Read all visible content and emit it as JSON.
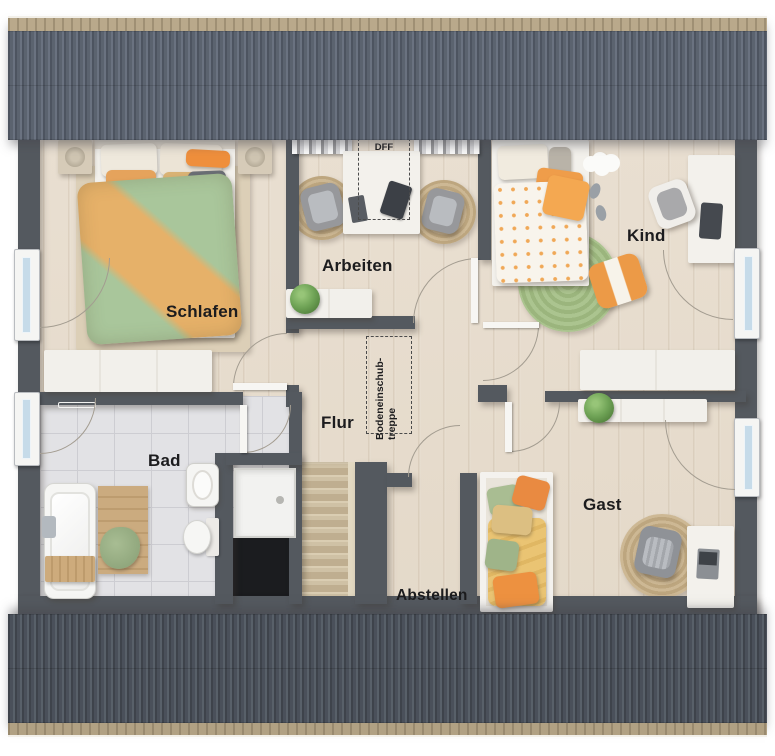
{
  "floorplan": {
    "rooms": [
      {
        "id": "schlafen",
        "label": "Schlafen"
      },
      {
        "id": "arbeiten",
        "label": "Arbeiten"
      },
      {
        "id": "kind",
        "label": "Kind"
      },
      {
        "id": "flur",
        "label": "Flur"
      },
      {
        "id": "bad",
        "label": "Bad"
      },
      {
        "id": "gast",
        "label": "Gast"
      },
      {
        "id": "abstellen",
        "label": "Abstellen"
      }
    ],
    "annotations": {
      "roof_window": "DFF",
      "attic_hatch_line1": "Bodeneinschub-",
      "attic_hatch_line2": "treppe"
    },
    "colors": {
      "roof_top": "#5b636f",
      "roof_bottom": "#4a505a",
      "roof_ridge": "#b9a98b",
      "wall": "#54595f",
      "wood_floor": "#e6dccd",
      "bath_tile": "#e2e2e5",
      "stair_wood": "#cfc1a5",
      "accent_orange": "#ec9a47",
      "accent_green": "#a9c69b",
      "rug_jute": "#cdb894",
      "window_glass": "#c6dbe9"
    }
  }
}
